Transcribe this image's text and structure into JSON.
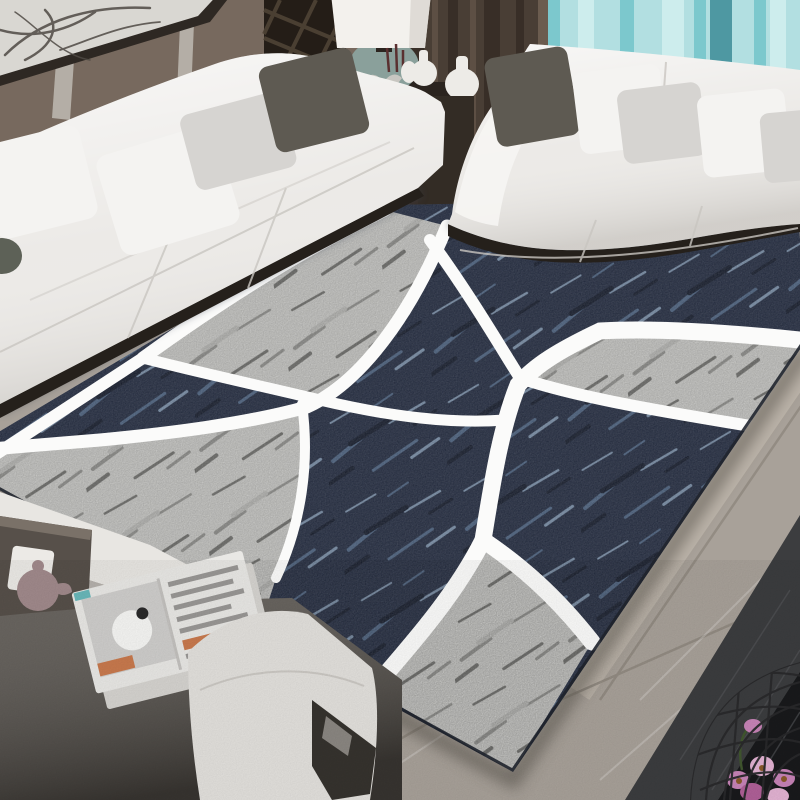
{
  "meta": {
    "scene": "Lifestyle product photo of a modern geometric area rug in a living room",
    "alt": "Living room with two white fabric sofas, framed abstract art, a table lamp, dark brown and teal curtains, a dark gray bench with an open magazine and tea tray, and a large navy-and-gray abstract rug crossed by white curved bands lying on a gray marble floor with a black tile border and a wire basket of pink orchids"
  },
  "objects": [
    {
      "name": "wall-art-frame",
      "desc": "dark framed abstract ink sketch on taupe wall"
    },
    {
      "name": "left-sofa",
      "desc": "white three-seat fabric sofa with white, gray and taupe pillows"
    },
    {
      "name": "right-sofa",
      "desc": "white fabric sofa in front of teal curtains"
    },
    {
      "name": "table-lamp",
      "desc": "white drum shade lamp with sage ceramic base"
    },
    {
      "name": "console-table",
      "desc": "dark wood side table with white vases and bird figurines"
    },
    {
      "name": "curtain-dark",
      "desc": "dark brown curtain panel"
    },
    {
      "name": "curtain-teal",
      "desc": "light teal striped curtain"
    },
    {
      "name": "area-rug",
      "desc": "navy and gray textured rug with sweeping white curved bands"
    },
    {
      "name": "bench",
      "desc": "dark gray bench with light cushion, open magazine and wood tea tray with teapot"
    },
    {
      "name": "floor",
      "desc": "gray marble tile floor with black glossy border"
    },
    {
      "name": "wire-basket",
      "desc": "black wire basket with pink orchid flowers"
    }
  ],
  "colors": {
    "wall": "#77695e",
    "wall_strip": "#cfccc5",
    "frame_border": "#2e2823",
    "frame_mat": "#d9d7d2",
    "frame_sketch": "#4f4a44",
    "lattice": "#241d17",
    "lattice_slat": "#4f4336",
    "curtain_dark": "#493e35",
    "curtain_dark_fold": "#352c25",
    "curtain_dark_edge": "#6b5c4f",
    "curtain_teal": "#b2dfe1",
    "curtain_teal_deep": "#4e98a2",
    "curtain_teal_mid": "#7cc8cd",
    "curtain_teal_pale": "#cdeded",
    "lamp_shade": "#f3f1ed",
    "lamp_shade_shadow": "#d9d6d0",
    "lamp_base": "#8aa09b",
    "vase_white": "#edebe7",
    "branch_red": "#5a3030",
    "bird_gray": "#c8c6c1",
    "table_dark": "#2b241f",
    "table_shelf": "#171310",
    "shelf_item": "#8f8c86",
    "gap_shadow": "#332c25",
    "sofa_white": "#eceae7",
    "sofa_highlight": "#f6f5f3",
    "sofa_crease": "#c9c6c1",
    "sofa_under_shadow": "#25201b",
    "pillow_white": "#f4f3f1",
    "pillow_gray": "#d6d4d1",
    "pillow_dark": "#5e5a52",
    "rug_navy": "#232c42",
    "rug_navy_deep": "#141b2c",
    "rug_navy_streak": "#4e6584",
    "rug_navy_streak_light": "#7d93ad",
    "rug_gray": "#cbcbc8",
    "rug_gray_light": "#b9b9b6",
    "rug_gray_mark": "#8f8f8c",
    "rug_gray_deep": "#6e6e6b",
    "rug_band": "#fbfbfa",
    "rug_edge_dark": "#20252e",
    "rug_shadow": "#4a443c",
    "sofa_cast_shadow": "#39404f",
    "floor_marble": "#a8a199",
    "floor_marble_light": "#beb6ab",
    "floor_grout": "#8e877e",
    "floor_vein": "#ffffff",
    "tile_charcoal": "#3c3d3f",
    "tile_black": "#191a1c",
    "tile_black_streak": "#55575a",
    "bench_dark": "#55504a",
    "bench_dark_deep": "#3f3c37",
    "bench_base_dark": "#36332e",
    "bench_slot": "#8b8782",
    "bench_cushion": "#e3e1dd",
    "side_table_white": "#e8e6e2",
    "side_table_edge": "#b5b1ac",
    "tray_wood": "#57504a",
    "tray_wood_edge": "#7a7168",
    "teapot": "#a18a8c",
    "paper_white": "#eceae6",
    "magazine_page": "#e9e8e5",
    "magazine_under": "#d6d4d0",
    "magazine_image_bg": "#cfcecc",
    "magazine_sphere": "#f6f6f4",
    "magazine_spot_dark": "#2b2b2b",
    "magazine_accent_orange": "#c97a4e",
    "magazine_accent_teal": "#6ab8ba",
    "magazine_text": "#9a9896",
    "magazine_gutter": "#c4c2bf",
    "basket_wire": "#2a2a2c",
    "flower_pink": "#c884b8",
    "flower_pink_deep": "#b06098",
    "flower_pink_light": "#e3b3d3",
    "flower_center": "#8a5a2a",
    "leaf_green": "#41572f",
    "decor_dark_green": "#5d6157"
  }
}
